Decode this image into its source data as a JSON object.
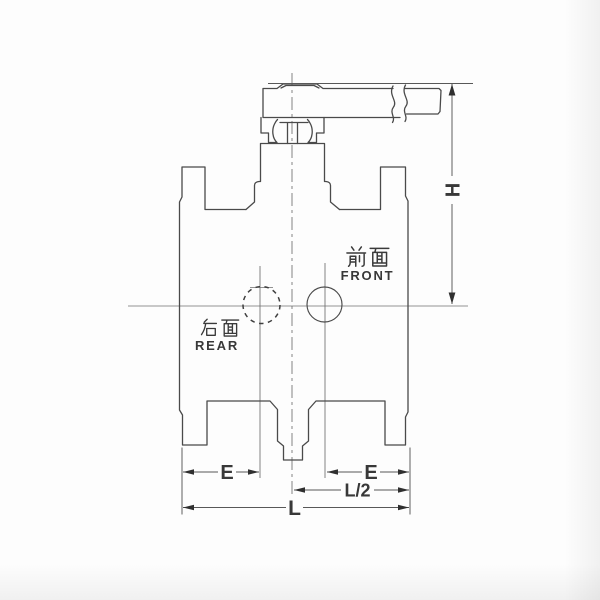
{
  "diagram": {
    "kind": "valve-elevation-drawing",
    "labels": {
      "front_cn": "前面",
      "front_en": "FRONT",
      "rear_cn": "后面",
      "rear_en": "REAR"
    },
    "dimensions": {
      "height": "H",
      "e_left": "E",
      "e_right": "E",
      "half_length": "L/2",
      "length": "L"
    }
  },
  "colors": {
    "body_line": "#4a4a4a",
    "dimension_line": "#585858",
    "centerline": "#6e6e6e",
    "text": "#383838",
    "background": "#fdfdfd"
  }
}
